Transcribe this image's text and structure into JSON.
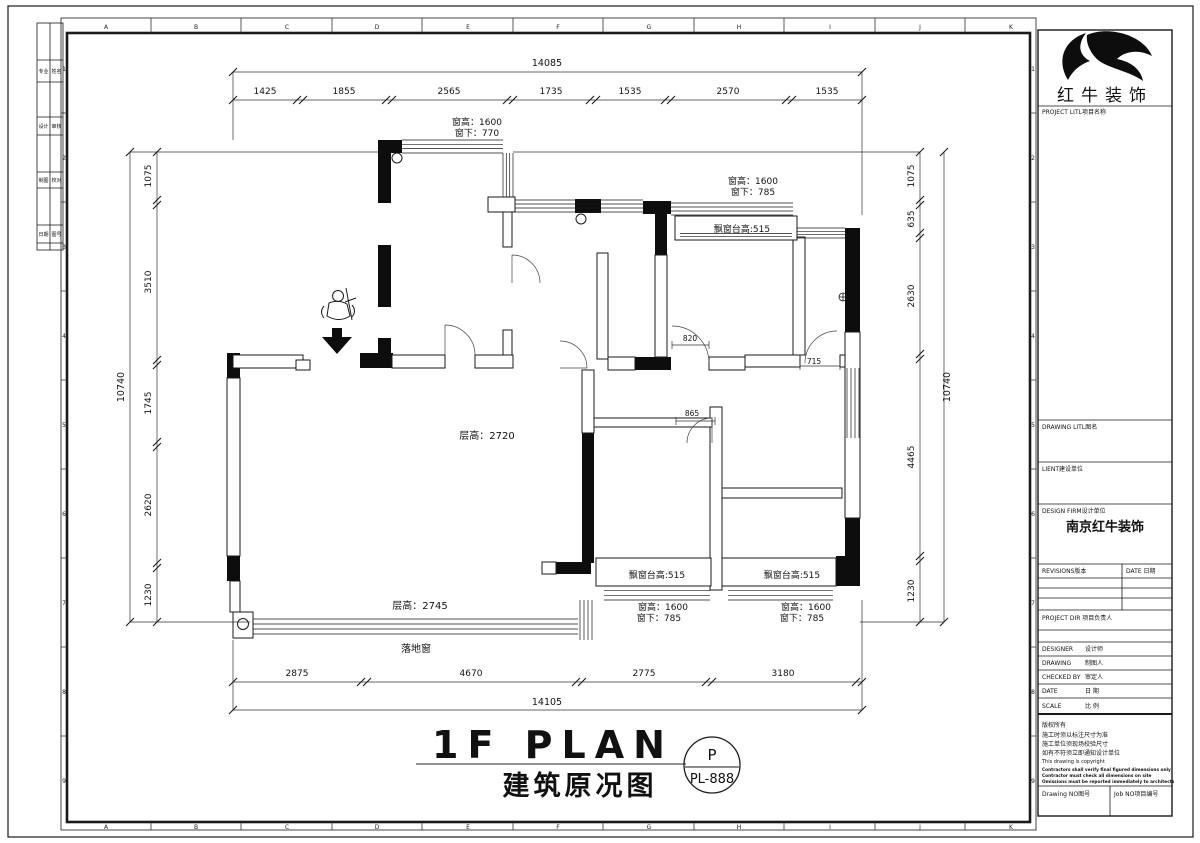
{
  "sheet": {
    "grid_letters": [
      "A",
      "B",
      "C",
      "D",
      "E",
      "F",
      "G",
      "H",
      "I",
      "J",
      "K"
    ],
    "grid_numbers": [
      "1",
      "2",
      "3",
      "4",
      "5",
      "6",
      "7",
      "8",
      "9"
    ],
    "line_color": "#1a1a1a"
  },
  "side_table": {
    "rows": [
      [
        "专业",
        "姓名"
      ],
      [
        "设计",
        "审核"
      ],
      [
        "制图",
        "校对"
      ],
      [
        "日期",
        "图号"
      ]
    ]
  },
  "title_block": {
    "company": "红牛装饰",
    "project_label": "PROJECT LITL项目名称",
    "drawing_label": "DRAWING LITL图名",
    "client_label": "LIENT建设单位",
    "design_firm_label": "DESIGN FIRM设计单位",
    "design_firm": "南京红牛装饰",
    "revisions_label": "REVISIONS版本",
    "date_col_label": "DATE 日期",
    "project_dir_label": "PROJECT DIR 项目负责人",
    "designer_label": "DESIGNER",
    "designer_cn": "设计师",
    "drawing_by_label": "DRAWING",
    "drawing_by_cn": "制图人",
    "checked_label": "CHECKED BY",
    "checked_cn": "审定人",
    "date_label": "DATE",
    "date_cn": "日 期",
    "scale_label": "SCALE",
    "scale_cn": "比 例",
    "copyright": [
      "版权所有",
      "施工时须以标注尺寸为准",
      "施工单位须现场校验尺寸",
      "如有不符须立即通知设计单位",
      "This drawing is copyright"
    ],
    "fine_print": [
      "Contractors shall verify final figured dimensions only",
      "Contractor must check all dimensions on site",
      "Omissions must be reported immediately to architects"
    ],
    "drawing_no_label": "Drawing NO图号",
    "job_no_label": "Job NO项目编号"
  },
  "plan": {
    "title_en": "1F PLAN",
    "title_cn": "建筑原况图",
    "badge_top": "P",
    "badge_code": "PL-888",
    "floor_height_main": "层高：2720",
    "floor_height_balcony": "层高：2745",
    "floor_window_label": "落地窗",
    "bay_sill_label": "飘窗台高:515",
    "win_top_left_l1": "窗高：1600",
    "win_top_left_l2": "窗下：770",
    "win_top_right_l1": "窗高：1600",
    "win_top_right_l2": "窗下：785",
    "win_bed2_l1": "窗高：1600",
    "win_bed2_l2": "窗下：785",
    "win_bed3_l1": "窗高：1600",
    "win_bed3_l2": "窗下：785",
    "dim_820": "820",
    "dim_715": "715",
    "dim_865": "865",
    "dims": {
      "top": {
        "total": "14085",
        "segments": [
          "1425",
          "1855",
          "2565",
          "1735",
          "1535",
          "2570",
          "1535"
        ]
      },
      "bottom": {
        "total": "14105",
        "segments": [
          "2875",
          "4670",
          "2775",
          "3180"
        ]
      },
      "left": {
        "total": "10740",
        "segments": [
          "1075",
          "3510",
          "1745",
          "2620",
          "1230"
        ]
      },
      "right": {
        "total": "10740",
        "segments": [
          "1075",
          "635",
          "2630",
          "4465",
          "1230"
        ]
      }
    }
  }
}
